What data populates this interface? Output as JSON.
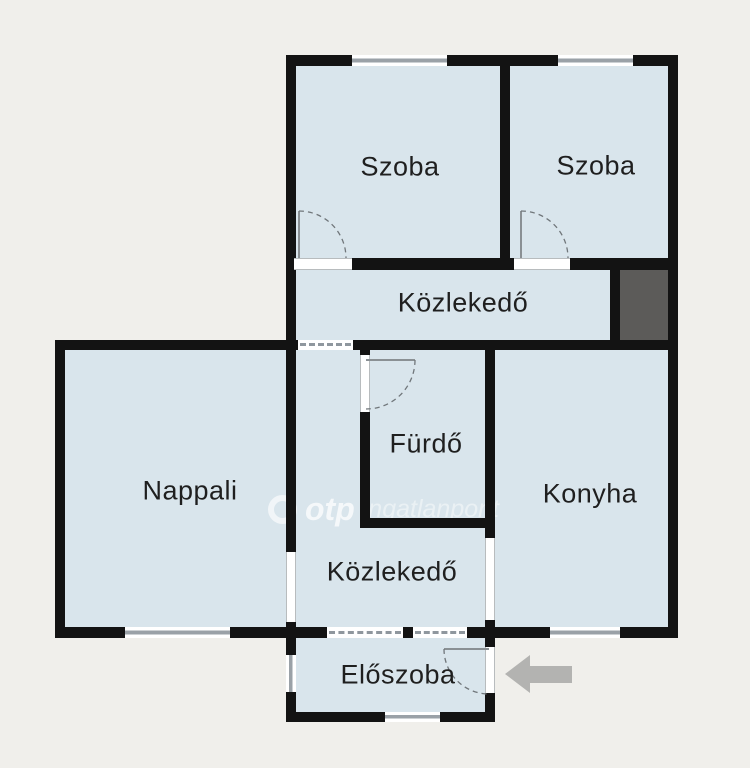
{
  "rooms": {
    "szoba_left": {
      "label": "Szoba"
    },
    "szoba_right": {
      "label": "Szoba"
    },
    "hallway_upper": {
      "label": "Közlekedő"
    },
    "nappali": {
      "label": "Nappali"
    },
    "furdo": {
      "label": "Fürdő"
    },
    "konyha": {
      "label": "Konyha"
    },
    "hallway_lower": {
      "label": "Közlekedő"
    },
    "eloszoba": {
      "label": "Előszoba"
    }
  },
  "watermark": {
    "brand": "otp",
    "name": "ingatlanpont"
  },
  "colors": {
    "room_fill": "#d9e5ec",
    "wall": "#131313",
    "background": "#f0efeb",
    "shaft": "#5c5b59",
    "arrow": "#b3b3b1",
    "label_text": "#1f1f1f"
  }
}
